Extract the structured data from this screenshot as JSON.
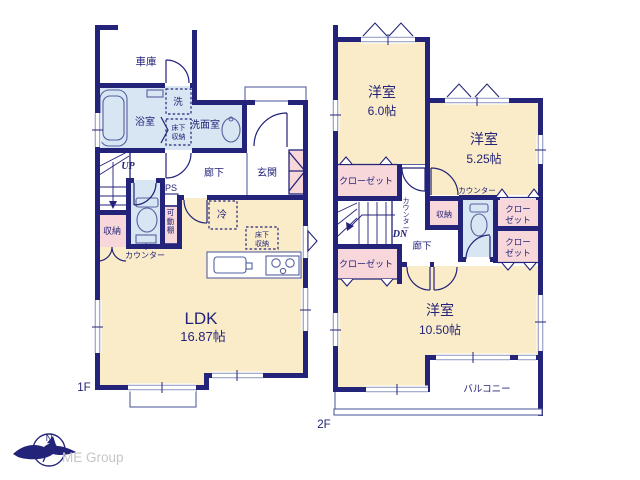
{
  "colors": {
    "bg": "#ffffff",
    "wall": "#232379",
    "room": "#faecc8",
    "wet": "#d8e6f3",
    "closet": "#f8d7db",
    "window": "#9aa2c8",
    "fixture": "#5560a0",
    "logo_text": "#c6c6ca"
  },
  "floor1": {
    "label": "1F",
    "garage": "車庫",
    "bath": "浴室",
    "washer": "洗",
    "washroom": "洗面室",
    "underfloor_l1": "床下",
    "underfloor_l2": "収納",
    "hallway": "廊下",
    "entrance": "玄関",
    "up": "UP",
    "ps": "PS",
    "shelf": "可動棚",
    "storage": "収納",
    "counter": "カウンター",
    "fridge": "冷",
    "ldk_underfloor_l1": "床下",
    "ldk_underfloor_l2": "収納",
    "ldk": "LDK",
    "ldk_size": "16.87帖"
  },
  "floor2": {
    "label": "2F",
    "bedroom_a": "洋室",
    "bedroom_a_size": "6.0帖",
    "bedroom_b": "洋室",
    "bedroom_b_size": "5.25帖",
    "bedroom_c": "洋室",
    "bedroom_c_size": "10.50帖",
    "closet_a": "クローゼット",
    "closet_b": "クローゼット",
    "closet_c_l1": "クロー",
    "closet_c_l2": "ゼット",
    "closet_d_l1": "クロー",
    "closet_d_l2": "ゼット",
    "dn": "DN",
    "hall_counter": "カウンター",
    "hallway": "廊下",
    "storage": "収納",
    "counter": "カウンター",
    "balcony": "バルコニー"
  },
  "logo": {
    "brand": "ME Group",
    "north": "N"
  }
}
